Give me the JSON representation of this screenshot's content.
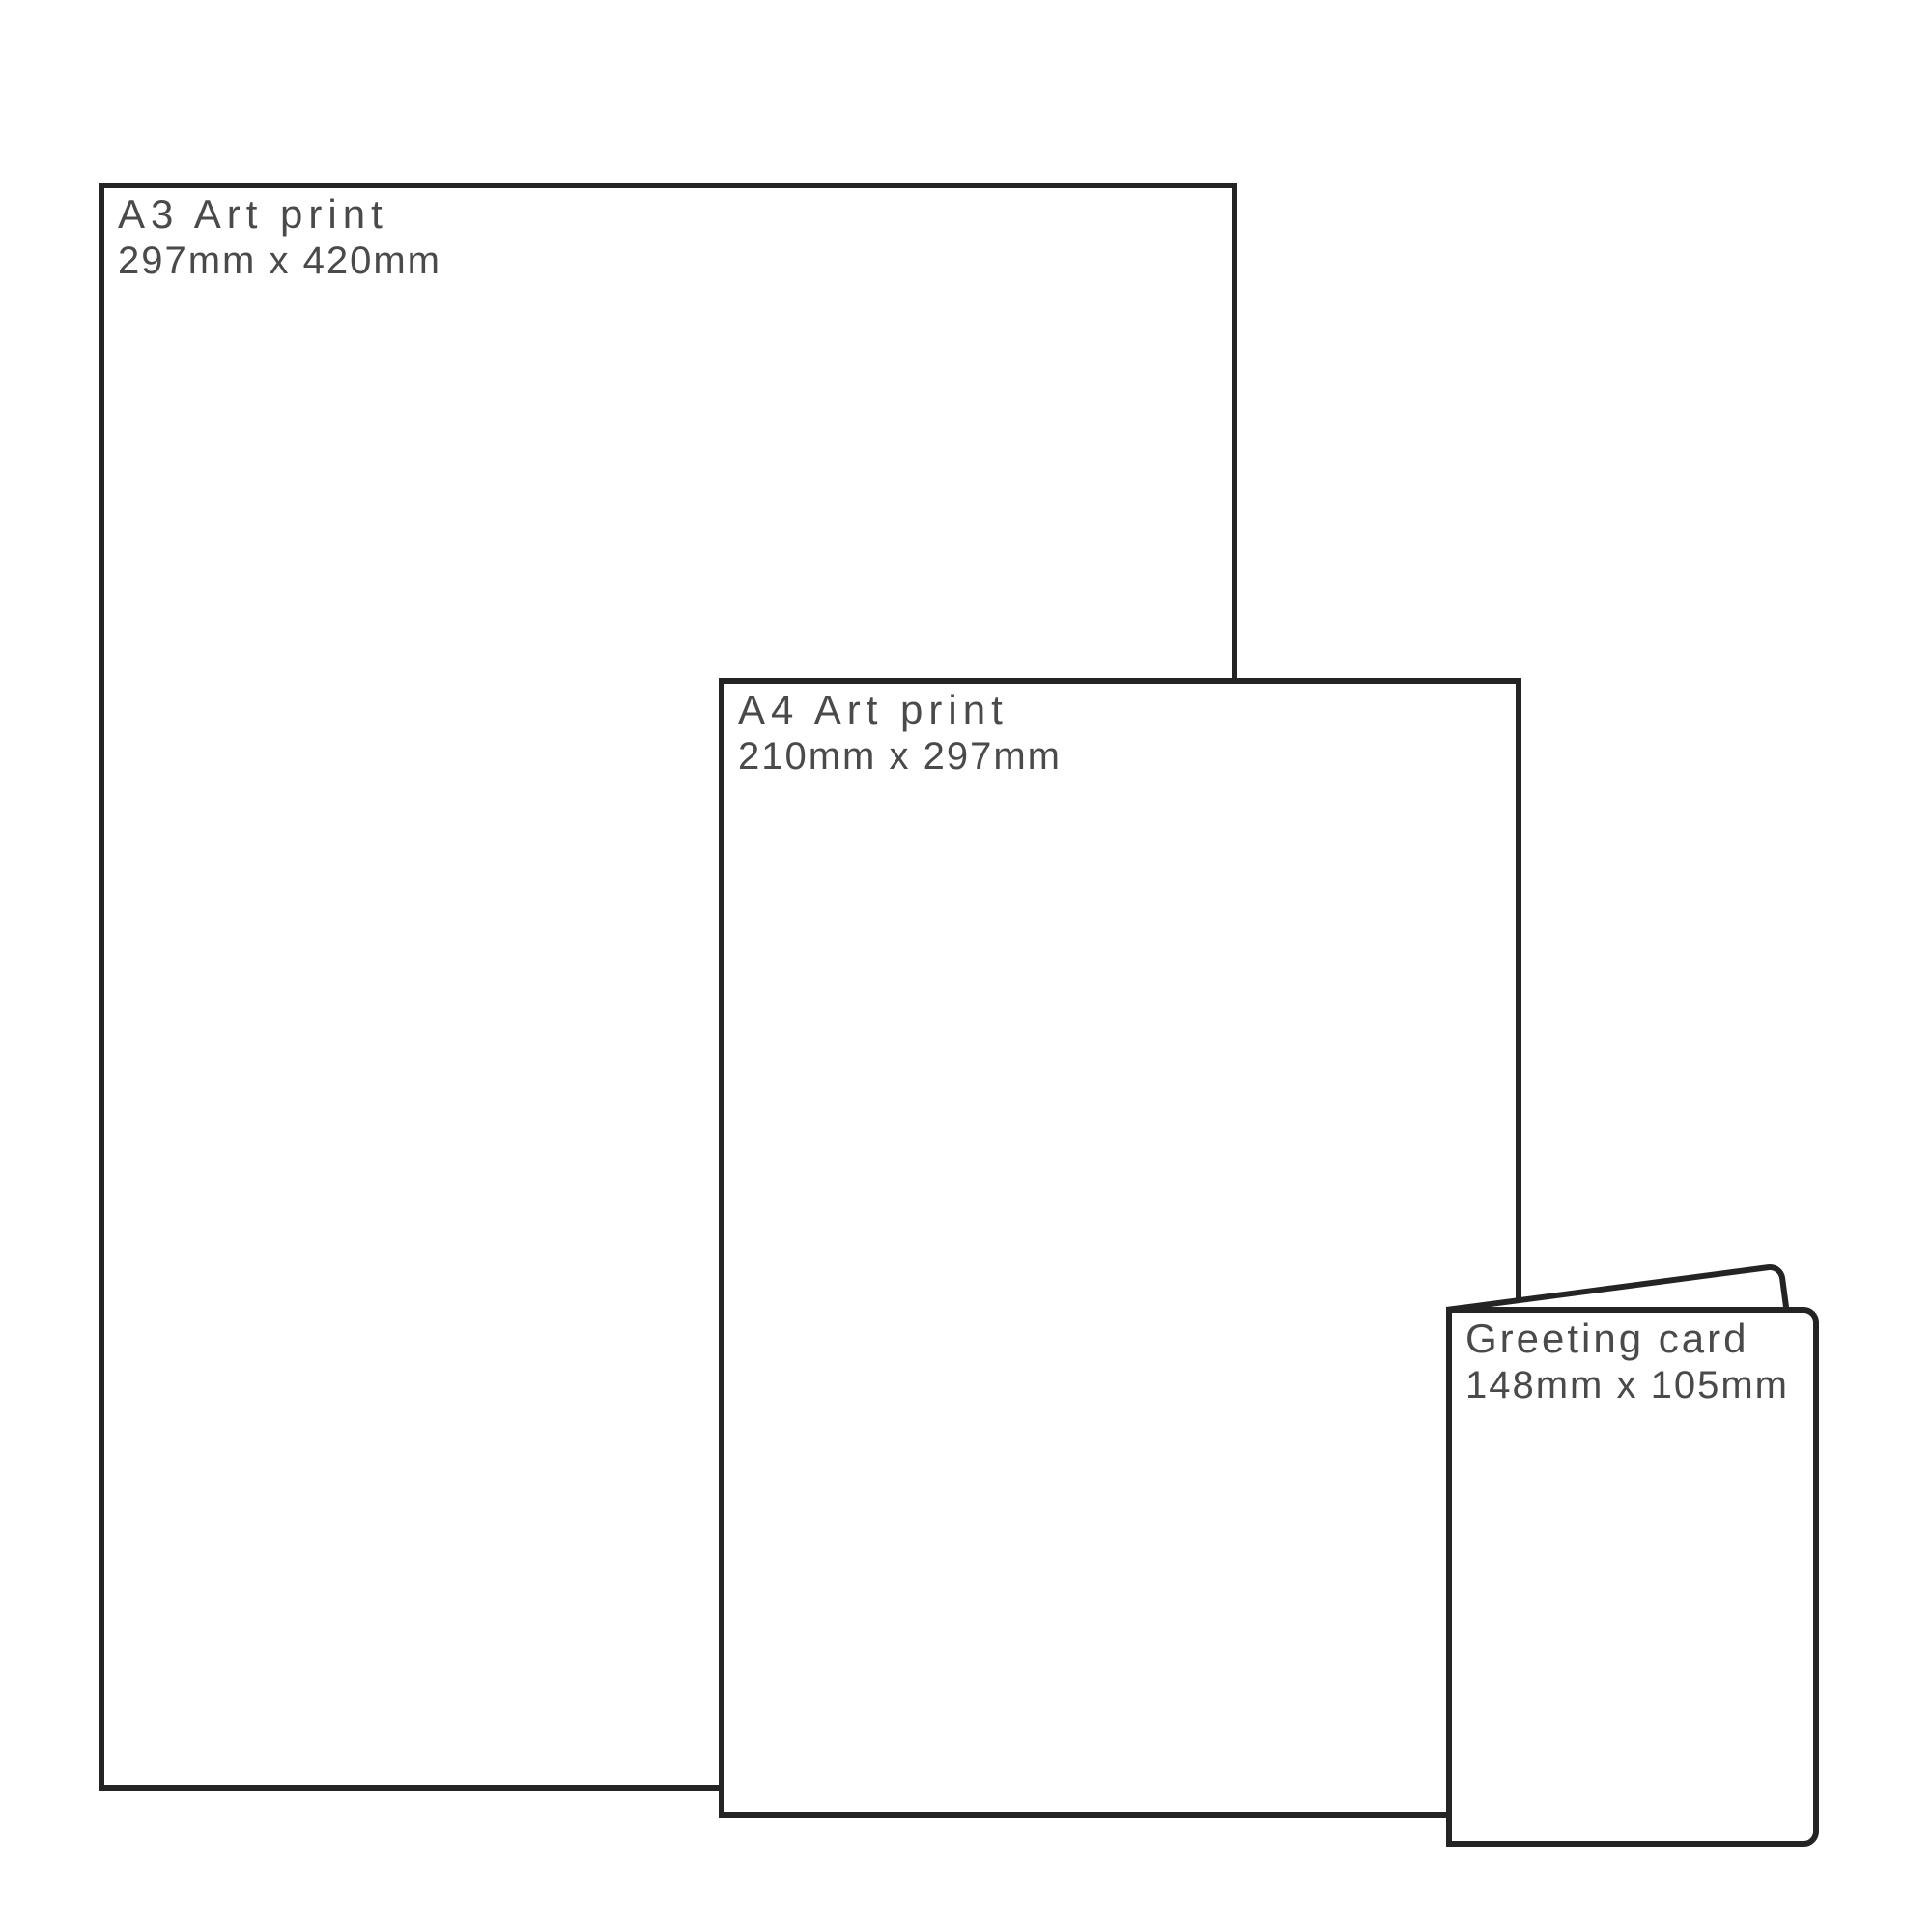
{
  "diagram": {
    "description": "Print product size comparison",
    "colors": {
      "outline": "#242424",
      "text": "#4a4a4a",
      "background": "#ffffff"
    },
    "items": [
      {
        "id": "a3-art-print",
        "title": "A3 Art print",
        "dimensions": "297mm x 420mm"
      },
      {
        "id": "a4-art-print",
        "title": "A4 Art print",
        "dimensions": "210mm x 297mm"
      },
      {
        "id": "greeting-card",
        "title": "Greeting card",
        "dimensions": "148mm x 105mm"
      }
    ]
  }
}
